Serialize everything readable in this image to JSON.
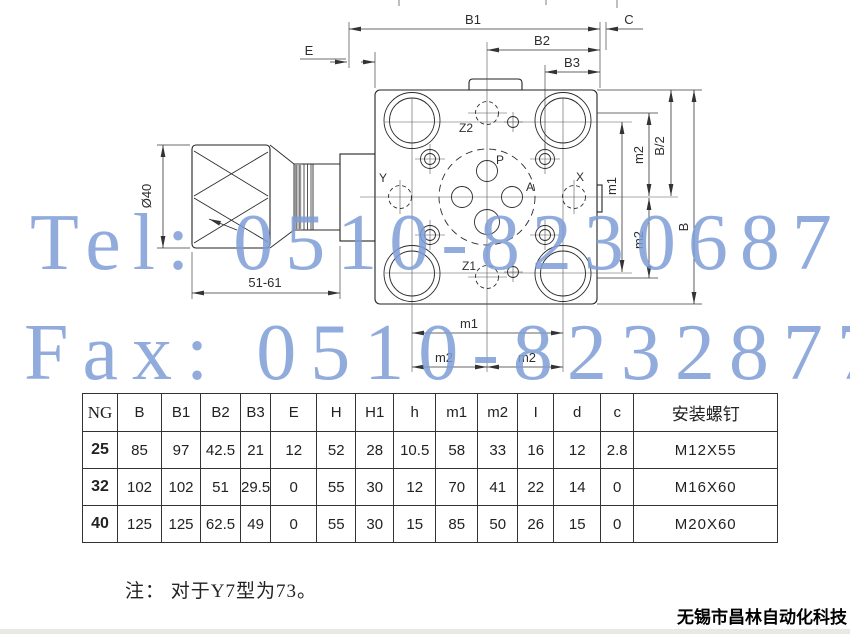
{
  "watermark": {
    "tel": "Tel: 0510-82306871",
    "fax": "Fax: 0510-82328771",
    "color": "#7e9ed7"
  },
  "drawing": {
    "labels": {
      "b1": "B1",
      "b2": "B2",
      "b3": "B3",
      "c": "C",
      "e": "E",
      "b_half": "B/2",
      "b_full": "B",
      "m1_right": "m1",
      "m2_upper": "m2",
      "m2_lower": "m2",
      "m1_bottom": "m1",
      "m2_bottom_left": "m2",
      "m2_bottom_right": "m2",
      "knob_diameter": "Ø40",
      "knob_length": "51-61",
      "port_z2": "Z2",
      "port_z1": "Z1",
      "port_p": "P",
      "port_a": "A",
      "port_x": "X",
      "port_y": "Y"
    }
  },
  "table": {
    "headers": [
      "NG",
      "B",
      "B1",
      "B2",
      "B3",
      "E",
      "H",
      "H1",
      "h",
      "m1",
      "m2",
      "I",
      "d",
      "c",
      "安装螺钉"
    ],
    "rows": [
      [
        "25",
        "85",
        "97",
        "42.5",
        "21",
        "12",
        "52",
        "28",
        "10.5",
        "58",
        "33",
        "16",
        "12",
        "2.8",
        "M12X55"
      ],
      [
        "32",
        "102",
        "102",
        "51",
        "29.5",
        "0",
        "55",
        "30",
        "12",
        "70",
        "41",
        "22",
        "14",
        "0",
        "M16X60"
      ],
      [
        "40",
        "125",
        "125",
        "62.5",
        "49",
        "0",
        "55",
        "30",
        "15",
        "85",
        "50",
        "26",
        "15",
        "0",
        "M20X60"
      ]
    ]
  },
  "note": "注： 对于Y7型为73。",
  "company": "无锡市昌林自动化科技"
}
